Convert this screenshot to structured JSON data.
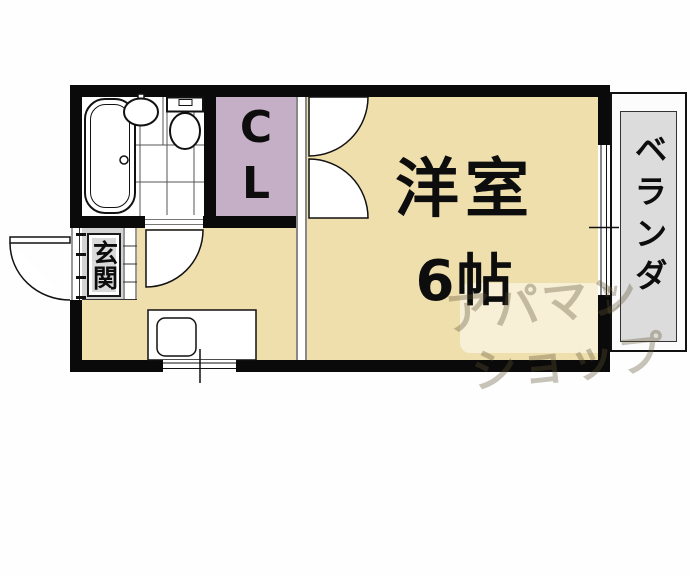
{
  "floorplan": {
    "rooms": {
      "western_room": {
        "name": "洋室",
        "size": "6帖"
      },
      "closet": {
        "letter_top": "C",
        "letter_bottom": "L"
      },
      "entrance": {
        "name": "玄関"
      },
      "balcony": {
        "name": "ベランダ"
      }
    },
    "fixtures": [
      "bathtub",
      "wash-basin",
      "toilet",
      "kitchen-counter",
      "kitchen-sink"
    ],
    "watermark": {
      "line1": "アパマン",
      "line2": "ショップ",
      "mark": "wレ"
    },
    "colors": {
      "wall": "#0a0a0a",
      "room_floor": "#efdfad",
      "closet_fill": "#c5afc6",
      "entrance_fill": "#d4d4d4",
      "balcony_fill": "#dcdcdc",
      "background": "#fefefe"
    }
  }
}
